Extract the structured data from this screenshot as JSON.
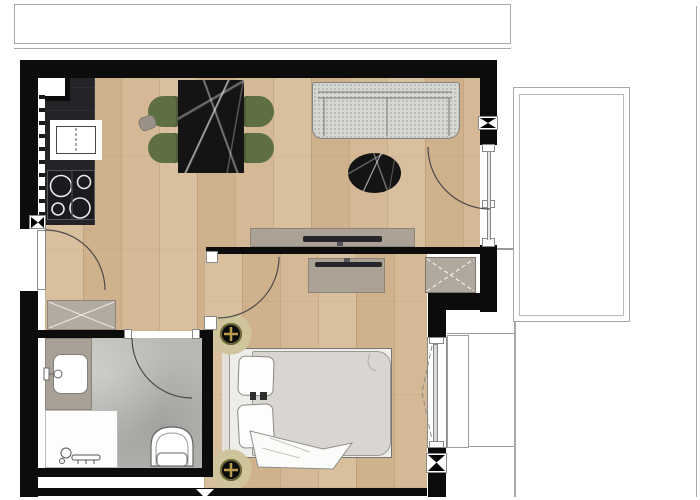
{
  "meta": {
    "document_type": "apartment-floor-plan",
    "canvas": {
      "width": 700,
      "height": 500
    },
    "visible_text": "none"
  },
  "palette": {
    "wall_black": "#0c0c0c",
    "wood_floor": "#d3b593",
    "stone_tile": "#bab8b4",
    "furniture_taupe": "#aba295",
    "sofa_gray": "#d6d6d3",
    "chair_olive": "#5f6f44",
    "marble_black": "#141414",
    "fixture_white": "#ffffff",
    "outline_gray": "#a8a8a8",
    "lamp_gold": "#b99c4a",
    "lamp_halo": "#cfc49b"
  },
  "exterior": {
    "items": [
      {
        "name": "terrace-top-outline",
        "shape": "thin-line-rectangle"
      },
      {
        "name": "balcony-right-outline",
        "shape": "double-thin-line-rectangle"
      },
      {
        "name": "balcony-right-rail",
        "shape": "vertical-line"
      },
      {
        "name": "site-boundary-line",
        "shape": "vertical-line"
      },
      {
        "name": "window-sill-ledge",
        "shape": "white-rectangle"
      }
    ]
  },
  "rooms": [
    {
      "id": "living-kitchen-dining",
      "floor": "wood",
      "furniture": [
        "kitchen-counter",
        "kitchen-corner-unit",
        "kitchen-sink",
        "cooktop-4-burners",
        "dining-table-marble",
        "dining-chair x4",
        "side-stool",
        "sofa",
        "coffee-table-oval-marble",
        "tv-sideboard-living",
        "tv-living"
      ]
    },
    {
      "id": "hallway",
      "floor": "wood",
      "furniture": [
        "hall-cabinet-crossed"
      ]
    },
    {
      "id": "bathroom",
      "floor": "stone",
      "furniture": [
        "vanity-counter",
        "wash-basin",
        "faucet",
        "shower-tray",
        "shower-mixer",
        "toilet"
      ]
    },
    {
      "id": "bedroom",
      "floor": "wood",
      "furniture": [
        "double-bed",
        "pillow x2",
        "duvet",
        "throw-blanket",
        "dresser-bedroom",
        "tv-bedroom",
        "service-shaft-crossed",
        "ceiling-light x2",
        "casement-window"
      ]
    }
  ],
  "openings": [
    {
      "name": "entry-door",
      "wall": "left",
      "swing": "quarter-arc-inward"
    },
    {
      "name": "bedroom-door",
      "wall": "partition",
      "swing": "quarter-arc-into-bedroom"
    },
    {
      "name": "bathroom-door",
      "wall": "bathroom-top",
      "swing": "quarter-arc-into-bathroom"
    },
    {
      "name": "balcony-door",
      "wall": "right",
      "swing": "quarter-arc-into-living"
    },
    {
      "name": "bedroom-window",
      "wall": "bedroom-right",
      "symbol": "glass-pane-with-dashed-opening-direction"
    }
  ],
  "markers": [
    {
      "name": "wall-joint-bowtie",
      "count": 3,
      "style": "black-hourglass-on-white-square"
    },
    {
      "name": "bottom-wall-triangle-marker",
      "style": "white-triangle-pointing-down"
    }
  ]
}
